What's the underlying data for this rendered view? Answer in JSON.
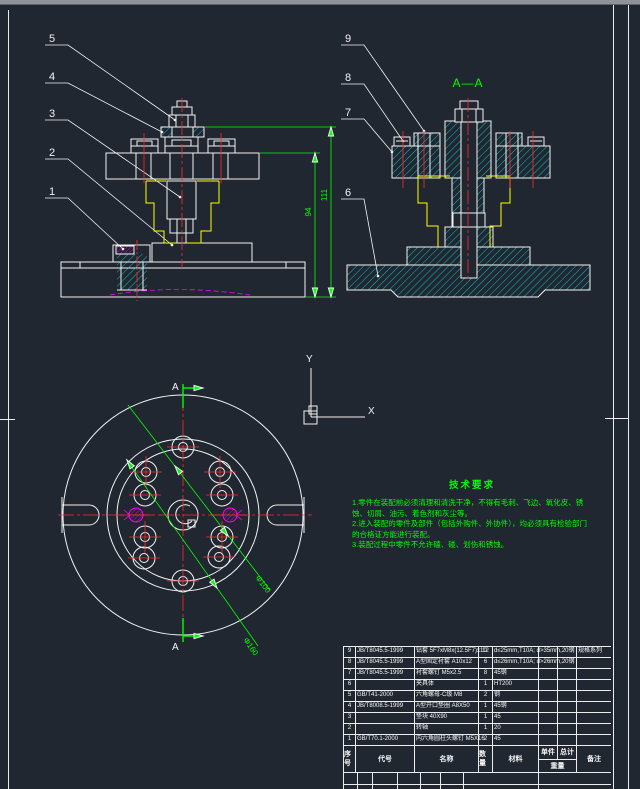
{
  "colors": {
    "background": "#212731",
    "line_white": "#f2f2f2",
    "dim_green": "#00ff00",
    "centerline_red": "#ff2a2a",
    "part_yellow": "#ffff00",
    "hatch_cyan": "#00ffff",
    "hidden_magenta": "#ff00ff"
  },
  "ucs": {
    "x_label": "X",
    "y_label": "Y"
  },
  "front_view": {
    "balloons": [
      "1",
      "2",
      "3",
      "4",
      "5"
    ],
    "dim_94": "94",
    "dim_111": "111"
  },
  "section_view": {
    "balloons": [
      "6",
      "7",
      "8",
      "9"
    ],
    "title": "A—A"
  },
  "top_view": {
    "section_label_top": "A",
    "section_label_bottom": "A",
    "dim_100": "Φ100",
    "dim_160": "Φ160"
  },
  "tech_requirements": {
    "title": "技术要求",
    "items": [
      "1.零件在装配前必须清理和清洗干净，不得有毛刺、飞边、氧化皮、锈蚀、切屑、油污、着色剂和灰尘等。",
      "2.进入装配的零件及部件（包括外购件、外协件），均必须具有检验部门的合格证方能进行装配。",
      "3.装配过程中零件不允许磕、碰、划伤和锈蚀。"
    ]
  },
  "bom": {
    "headers": {
      "no": "序号",
      "code": "代号",
      "name": "名称",
      "qty": "数量",
      "material": "材料",
      "unit": "单件",
      "total": "总计",
      "weight": "重量",
      "remark": "备注"
    },
    "rows": [
      {
        "no": "9",
        "code": "JB/T8045.5-1999",
        "name": "钻套 5F7xM8x(12.5F7)x10",
        "qty": "12",
        "material": "d≤25mm,T10A; d>35mm,20钢",
        "unit": "",
        "total": "",
        "remark": "规格系列"
      },
      {
        "no": "8",
        "code": "JB/T8045.5-1999",
        "name": "A型固定衬套 A10x12",
        "qty": "6",
        "material": "d≤26mm,T10A; d>26mm,20钢",
        "unit": "",
        "total": "",
        "remark": ""
      },
      {
        "no": "7",
        "code": "JB/T8045.5-1999",
        "name": "衬套螺钉 M5x2.5",
        "qty": "8",
        "material": "45钢",
        "unit": "",
        "total": "",
        "remark": ""
      },
      {
        "no": "6",
        "code": "",
        "name": "夹具体",
        "qty": "1",
        "material": "HT200",
        "unit": "",
        "total": "",
        "remark": ""
      },
      {
        "no": "5",
        "code": "GB/T41-2000",
        "name": "六角螺母-C级 M8",
        "qty": "2",
        "material": "钢",
        "unit": "",
        "total": "",
        "remark": ""
      },
      {
        "no": "4",
        "code": "JB/T8008.5-1999",
        "name": "A型开口垫圈 A8X50",
        "qty": "1",
        "material": "45钢",
        "unit": "",
        "total": "",
        "remark": ""
      },
      {
        "no": "3",
        "code": "",
        "name": "垫块 40X90",
        "qty": "1",
        "material": "45",
        "unit": "",
        "total": "",
        "remark": ""
      },
      {
        "no": "2",
        "code": "",
        "name": "转轴",
        "qty": "1",
        "material": "20",
        "unit": "",
        "total": "",
        "remark": ""
      },
      {
        "no": "1",
        "code": "GB/T70.1-2000",
        "name": "内六角圆柱头螺钉 M5X16",
        "qty": "2",
        "material": "45",
        "unit": "",
        "total": "",
        "remark": ""
      }
    ]
  }
}
